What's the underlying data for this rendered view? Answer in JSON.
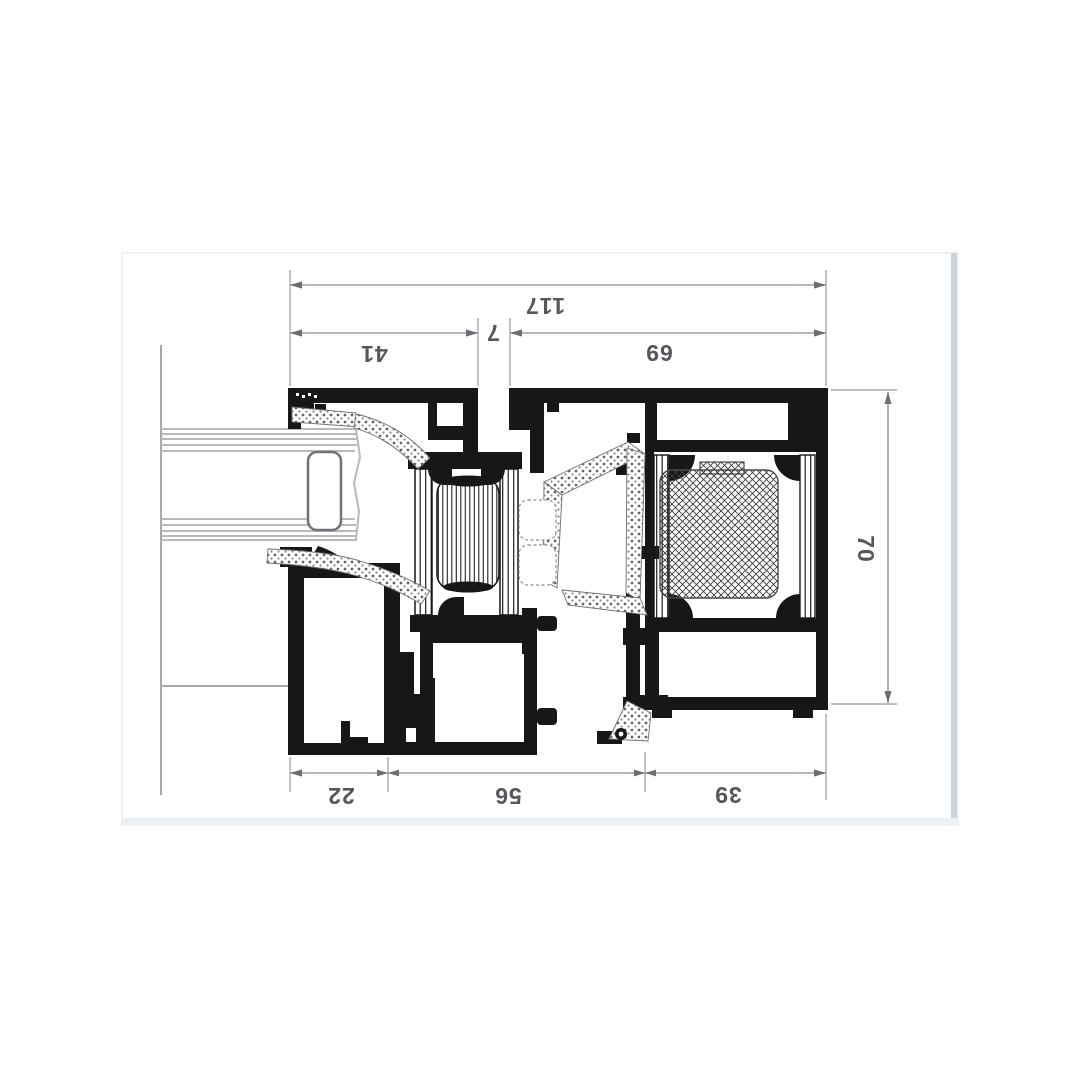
{
  "canvas": {
    "background": "#ffffff",
    "border_color": "#e9edf0",
    "right_edge_color": "#ccd3d8",
    "bottom_edge_color": "#edf1f5"
  },
  "drawing": {
    "ink_color": "#17171a",
    "dim_line_color": "#9aa0a5",
    "dim_text_color": "#54585c",
    "panel_line_color": "#b6babd",
    "dims": {
      "total_width": "117",
      "sash_width": "41",
      "gap": "7",
      "frame_width": "69",
      "frame_height": "70",
      "sill_left": "22",
      "sash_bottom": "56",
      "frame_bottom": "39"
    }
  }
}
